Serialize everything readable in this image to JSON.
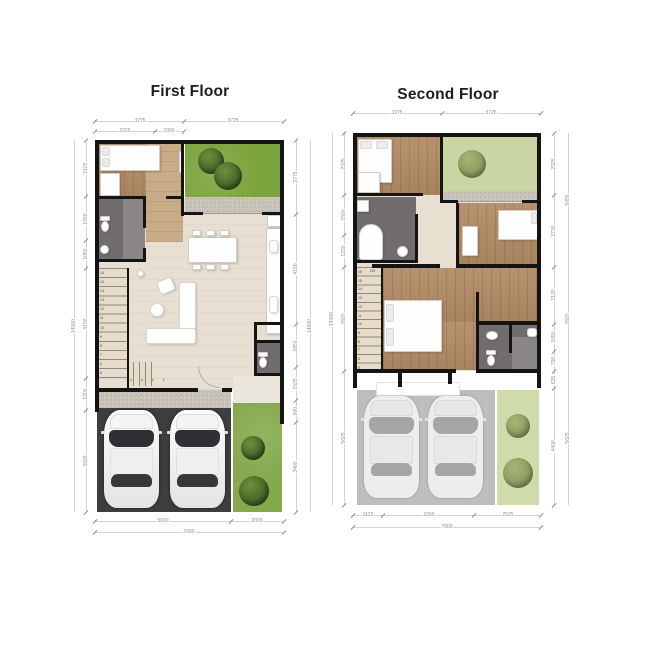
{
  "first": {
    "title": "First Floor",
    "dims": {
      "top1": [
        "3275",
        "3725"
      ],
      "top2": [
        "2225",
        "1050"
      ],
      "left_total": "14000",
      "left": [
        "2125",
        "1650",
        "1050",
        "4150",
        "1200",
        "3825"
      ],
      "right": [
        "2775",
        "4150",
        "1851",
        "1525",
        "800",
        "3400"
      ],
      "right_total": "14000",
      "bottom": [
        "5000",
        "2000"
      ],
      "bottom_total": "7000"
    },
    "stairs": {
      "run_numbers": "16\n15\n14\n13\n12\n11\n10\n9\n8\n7\n6\n5",
      "turn_numbers": "4 3 2 1"
    }
  },
  "second": {
    "title": "Second Floor",
    "dims": {
      "top1": [
        "3275",
        "3725"
      ],
      "left_total": "14000",
      "left": [
        "2325",
        "1500",
        "1230",
        "3920",
        "5025"
      ],
      "right": [
        "2325",
        "2730",
        "2120",
        "1050",
        "750",
        "625",
        "4400"
      ],
      "right_outer": [
        "5055",
        "3920",
        "5025"
      ],
      "bottom": [
        "1125",
        "3350",
        "2525"
      ],
      "bottom_total": "7000"
    },
    "stairs": {
      "run_numbers": "16\n15\n14\n13\n12\n11\n10\n9\n8\n7\n6\n5",
      "dn_label": "DN"
    }
  },
  "colors": {
    "wall": "#141414",
    "wood_floor": "#b28b66",
    "living_floor": "#e7dfd2",
    "garden_green": "#7ca43e",
    "roof_garden_green": "#c9d5a3",
    "bathroom_gray": "#716d6e",
    "driveway_asphalt": "#3d3d3f",
    "lawn_green": "#85a94c",
    "dimension_text": "#8f8f8f"
  }
}
